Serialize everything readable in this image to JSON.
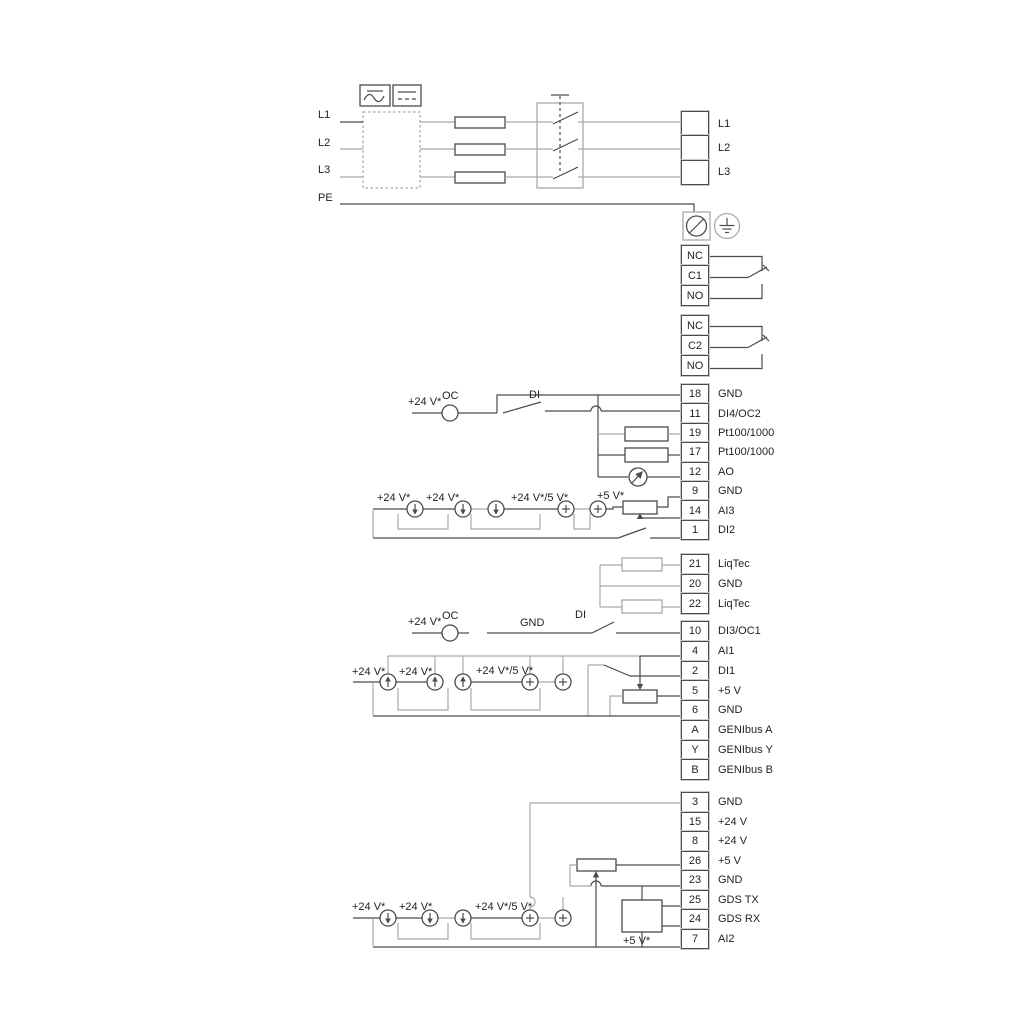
{
  "diagram": {
    "mains": {
      "inputs": [
        {
          "label": "L1"
        },
        {
          "label": "L2"
        },
        {
          "label": "L3"
        },
        {
          "label": "PE"
        }
      ],
      "outputs": [
        {
          "label": "L1"
        },
        {
          "label": "L2"
        },
        {
          "label": "L3"
        }
      ]
    },
    "relay1": [
      {
        "label": "NC"
      },
      {
        "label": "C1"
      },
      {
        "label": "NO"
      }
    ],
    "relay2": [
      {
        "label": "NC"
      },
      {
        "label": "C2"
      },
      {
        "label": "NO"
      }
    ],
    "io_top": [
      {
        "pin": "18",
        "label": "GND"
      },
      {
        "pin": "11",
        "label": "DI4/OC2"
      },
      {
        "pin": "19",
        "label": "Pt100/1000"
      },
      {
        "pin": "17",
        "label": "Pt100/1000"
      },
      {
        "pin": "12",
        "label": "AO"
      },
      {
        "pin": "9",
        "label": "GND"
      },
      {
        "pin": "14",
        "label": "AI3"
      },
      {
        "pin": "1",
        "label": "DI2"
      }
    ],
    "liqtec": [
      {
        "pin": "21",
        "label": "LiqTec"
      },
      {
        "pin": "20",
        "label": "GND"
      },
      {
        "pin": "22",
        "label": "LiqTec"
      }
    ],
    "io_mid": [
      {
        "pin": "10",
        "label": "DI3/OC1"
      },
      {
        "pin": "4",
        "label": "AI1"
      },
      {
        "pin": "2",
        "label": "DI1"
      },
      {
        "pin": "5",
        "label": "+5 V"
      },
      {
        "pin": "6",
        "label": "GND"
      },
      {
        "pin": "A",
        "label": "GENIbus A"
      },
      {
        "pin": "Y",
        "label": "GENIbus Y"
      },
      {
        "pin": "B",
        "label": "GENIbus B"
      }
    ],
    "io_bottom": [
      {
        "pin": "3",
        "label": "GND"
      },
      {
        "pin": "15",
        "label": "+24 V"
      },
      {
        "pin": "8",
        "label": "+24 V"
      },
      {
        "pin": "26",
        "label": "+5 V"
      },
      {
        "pin": "23",
        "label": "GND"
      },
      {
        "pin": "25",
        "label": "GDS TX"
      },
      {
        "pin": "24",
        "label": "GDS RX"
      },
      {
        "pin": "7",
        "label": "AI2"
      }
    ],
    "annotations": {
      "row_oc2": {
        "v24": "+24 V*",
        "oc": "OC",
        "di": "DI"
      },
      "row_ai3": {
        "v24a": "+24 V*",
        "v24b": "+24 V*",
        "v24_5": "+24 V*/5 V*",
        "v5": "+5 V*"
      },
      "row_oc1": {
        "v24": "+24 V*",
        "oc": "OC",
        "gnd": "GND",
        "di": "DI"
      },
      "row_ai1": {
        "v24a": "+24 V*",
        "v24b": "+24 V*",
        "v24_5": "+24 V*/5 V*"
      },
      "row_ai2": {
        "v24a": "+24 V*",
        "v24b": "+24 V*",
        "v24_5": "+24 V*/5 V*",
        "v5": "+5 V*"
      }
    },
    "colors": {
      "wire_dark": "#4a4b4d",
      "wire_gray": "#a7a9ac",
      "text": "#231f20"
    }
  }
}
